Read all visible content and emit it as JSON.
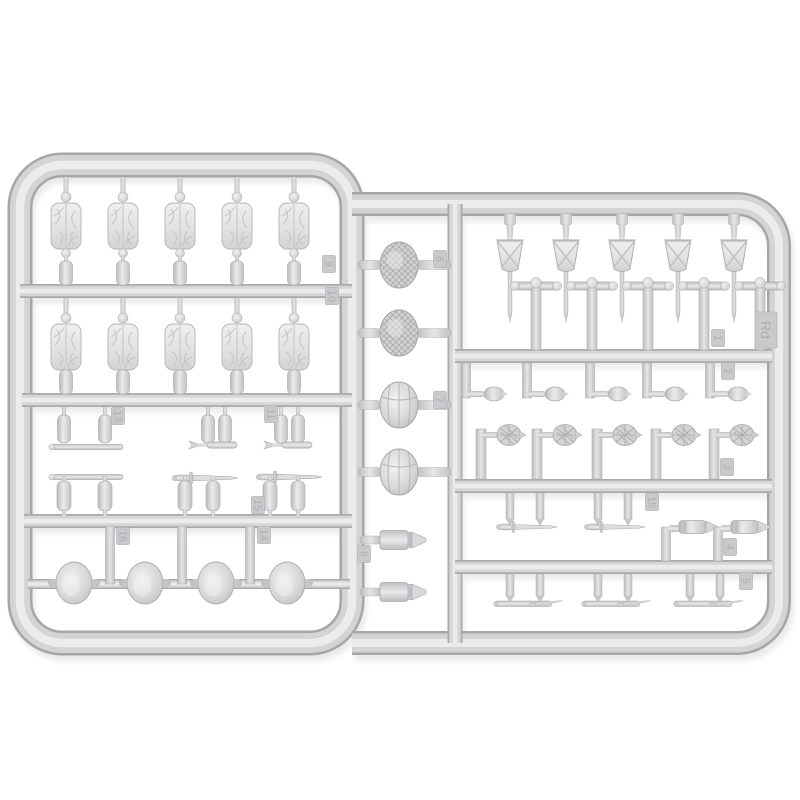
{
  "scene": {
    "type": "product-photo",
    "subject": "Light grey injection-moulded model kit sprue (runner) holding small-scale military equipment accessories, photographed on a white background",
    "sprue_code": "Rd",
    "plastic_color": "#d2d2d4",
    "plastic_highlight": "#ececee",
    "plastic_shadow": "#a6a6a9",
    "background_color": "#ffffff"
  },
  "tags": [
    {
      "label": "9"
    },
    {
      "label": "10"
    },
    {
      "label": "13"
    },
    {
      "label": "11"
    },
    {
      "label": "15"
    },
    {
      "label": "16"
    },
    {
      "label": "14"
    },
    {
      "label": "6"
    },
    {
      "label": "7"
    },
    {
      "label": "8"
    },
    {
      "label": "1"
    },
    {
      "label": "Rd"
    },
    {
      "label": "2"
    },
    {
      "label": "3"
    },
    {
      "label": "15"
    },
    {
      "label": "4"
    },
    {
      "label": "5"
    }
  ],
  "part_groups": [
    {
      "name": "rolled-tarpaulin-pack",
      "count": 10
    },
    {
      "name": "water-bottle",
      "count": 12
    },
    {
      "name": "helmet-with-net",
      "count": 2
    },
    {
      "name": "ridged-helmet",
      "count": 2
    },
    {
      "name": "plain-helmet",
      "count": 4
    },
    {
      "name": "shell-projectile",
      "count": 2
    },
    {
      "name": "spade-in-cover",
      "count": 5
    },
    {
      "name": "t-handle-grip",
      "count": 5
    },
    {
      "name": "egg-grenade",
      "count": 5
    },
    {
      "name": "pineapple-grenade",
      "count": 5
    },
    {
      "name": "bayonet",
      "count": 2
    },
    {
      "name": "rifle-grenade",
      "count": 2
    },
    {
      "name": "scabbard-with-bayonet",
      "count": 3
    },
    {
      "name": "entrenching-shovel",
      "count": 3
    },
    {
      "name": "fighting-knife",
      "count": 2
    },
    {
      "name": "cleaning-rod",
      "count": 2
    }
  ]
}
